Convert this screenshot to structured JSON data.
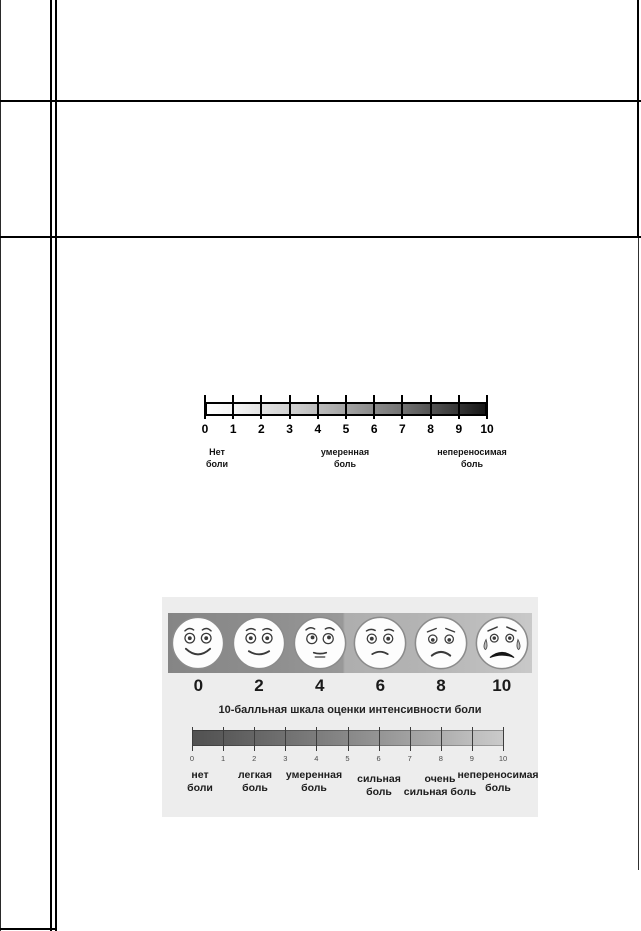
{
  "colors": {
    "table_border": "#000000",
    "image_background": "#ededed",
    "numeric_gradient_start": "#ffffff",
    "numeric_gradient_end": "#161616",
    "lower_gradient_start": "#515151",
    "lower_gradient_end": "#cacaca"
  },
  "numeric_scale": {
    "ticks": [
      "0",
      "1",
      "2",
      "3",
      "4",
      "5",
      "6",
      "7",
      "8",
      "9",
      "10"
    ],
    "labels": [
      {
        "line1": "Нет",
        "line2": "боли"
      },
      {
        "line1": "умеренная",
        "line2": "боль"
      },
      {
        "line1": "непереносимая",
        "line2": "боль"
      }
    ]
  },
  "faces_scale": {
    "title": "10-балльная шкала оценки интенсивности боли",
    "faces": [
      {
        "value": "0",
        "expression": "very-happy"
      },
      {
        "value": "2",
        "expression": "happy"
      },
      {
        "value": "4",
        "expression": "neutral"
      },
      {
        "value": "6",
        "expression": "slight-frown"
      },
      {
        "value": "8",
        "expression": "frown"
      },
      {
        "value": "10",
        "expression": "crying"
      }
    ],
    "bar_ticks": [
      "0",
      "1",
      "2",
      "3",
      "4",
      "5",
      "6",
      "7",
      "8",
      "9",
      "10"
    ],
    "labels": [
      {
        "line1": "нет",
        "line2": "боли"
      },
      {
        "line1": "легкая",
        "line2": "боль"
      },
      {
        "line1": "умеренная",
        "line2": "боль"
      },
      {
        "line1": "сильная",
        "line2": "боль"
      },
      {
        "line1": "очень",
        "line2": "сильная боль"
      },
      {
        "line1": "непереносимая",
        "line2": "боль"
      }
    ]
  }
}
